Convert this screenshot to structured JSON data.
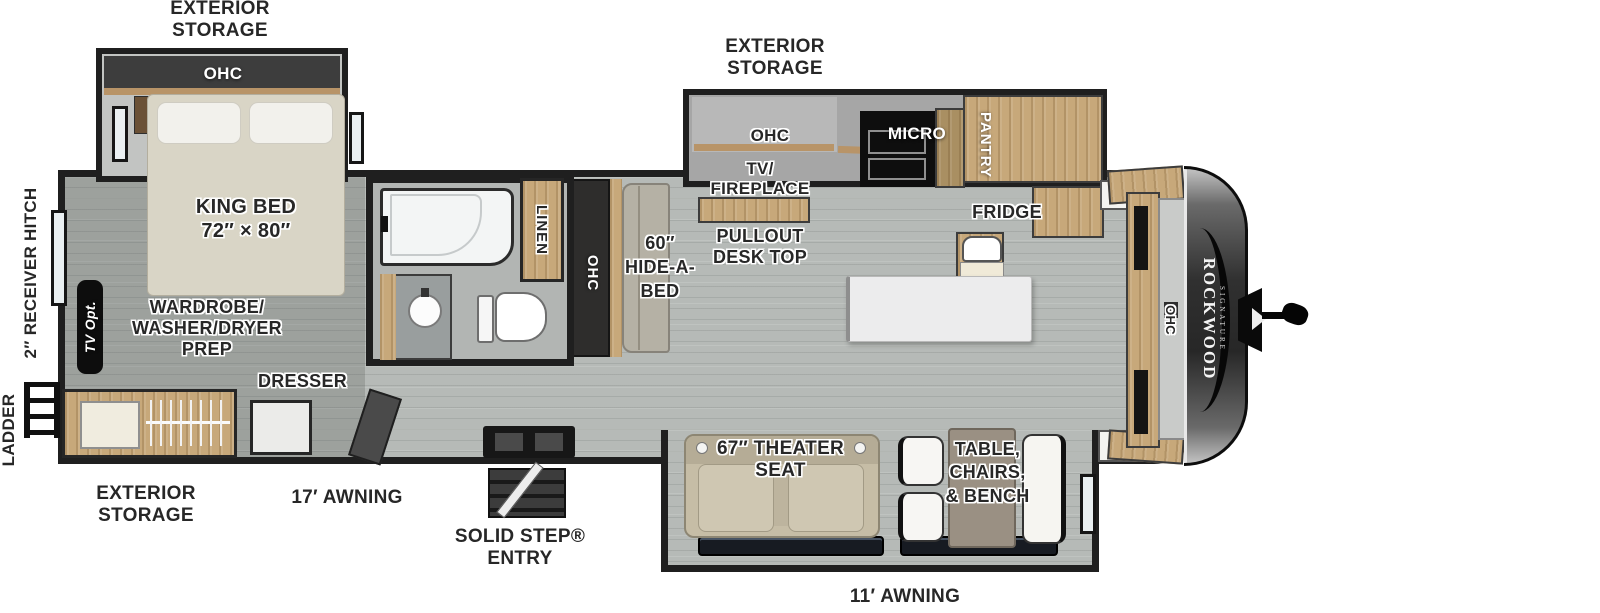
{
  "floorplan": {
    "brand": "ROCKWOOD",
    "brand_sub": "SIGNATURE",
    "colors": {
      "wall": "#1f1f1f",
      "floor": "#b6bab7",
      "wood_cabinet": "#c7a87a",
      "fabric": "#d9d5c6",
      "label_text": "#272727",
      "label_halo": "#ffffff",
      "front_cap": "#2d2d2d"
    },
    "labels": {
      "exterior_storage_top_left": "EXTERIOR\nSTORAGE",
      "exterior_storage_top_right": "EXTERIOR\nSTORAGE",
      "exterior_storage_bottom_left": "EXTERIOR\nSTORAGE",
      "ohc_bedroom": "OHC",
      "king_bed": "KING BED\n72″ × 80″",
      "ladder": "LADDER",
      "receiver_hitch": "2″ RECEIVER HITCH",
      "tv_opt": "TV Opt.",
      "wardrobe": "WARDROBE/\nWASHER/DRYER\nPREP",
      "dresser": "DRESSER",
      "awning_17": "17′ AWNING",
      "solid_step_entry": "SOLID STEP®\nENTRY",
      "linen": "LINEN",
      "ohc_hallway": "OHC",
      "hide_a_bed": "60″\nHIDE-A-\nBED",
      "ohc_kitchen": "OHC",
      "tv_fireplace": "TV/\nFIREPLACE",
      "pullout_desk_top": "PULLOUT\nDESK TOP",
      "micro": "MICRO",
      "pantry": "PANTRY",
      "fridge": "FRIDGE",
      "theater_seat": "67″ THEATER\nSEAT",
      "table_chairs_bench": "TABLE,\nCHAIRS,\n& BENCH",
      "awning_11": "11′ AWNING",
      "ohc_front": "OHC"
    }
  }
}
